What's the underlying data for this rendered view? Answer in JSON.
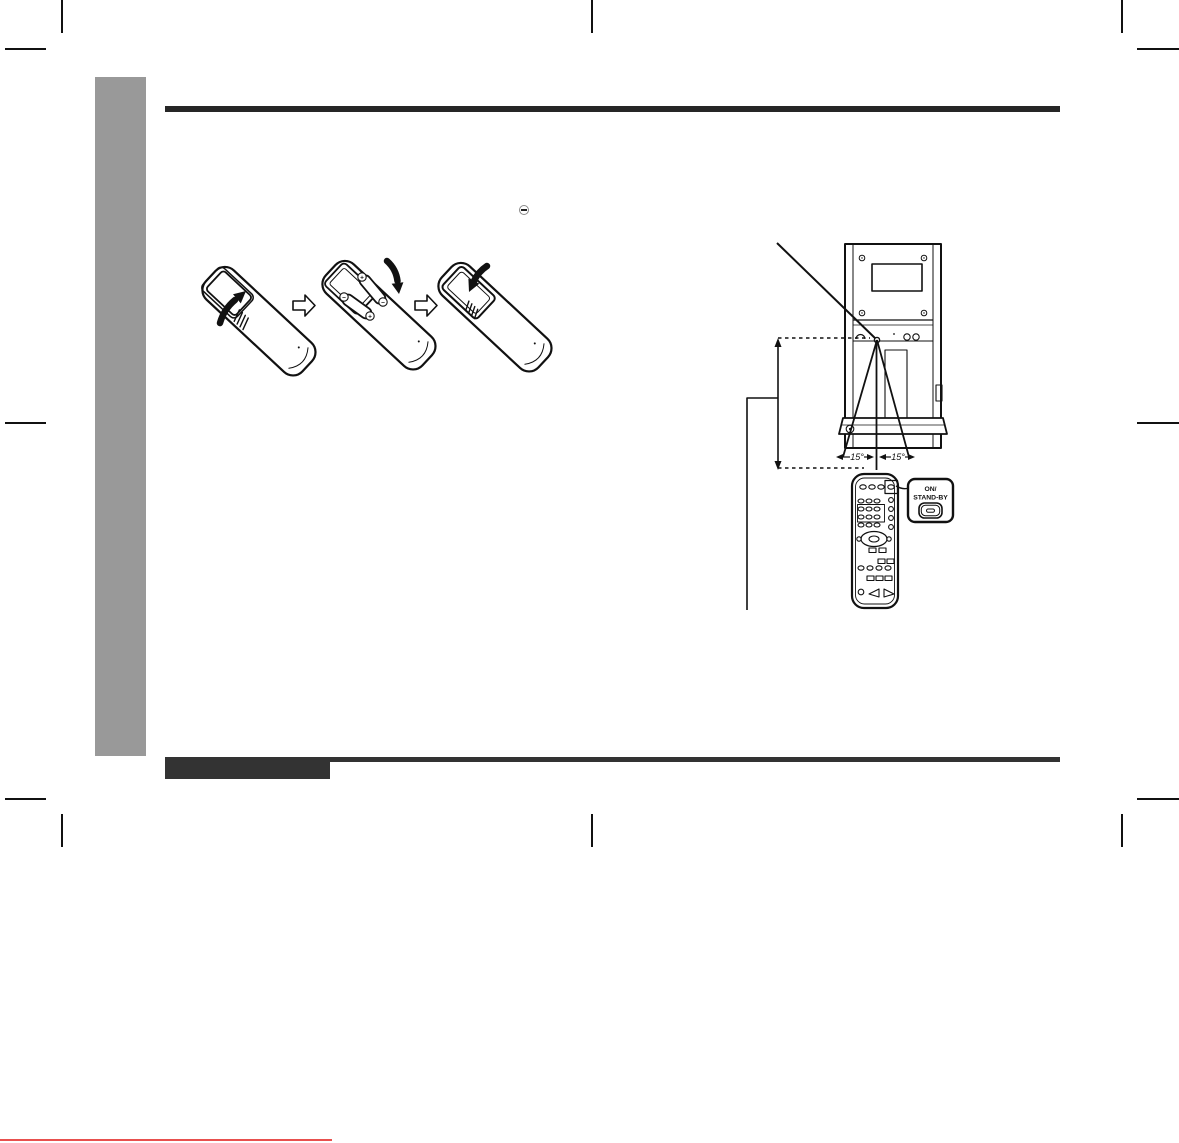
{
  "page": {
    "bg_color": "#ffffff",
    "ink_color": "#111111",
    "sidebar_color": "#999999",
    "header_rule_color": "#262626",
    "footer_bar_color": "#333333",
    "red_line_color": "#e8504e"
  },
  "margin_note": {
    "minus_symbol": "−"
  },
  "battery_diagram": {
    "polarity_plus": "+",
    "polarity_minus": "−"
  },
  "range_diagram": {
    "angle_left_label": "15°",
    "angle_right_label": "15°",
    "callout_title_line1": "ON/",
    "callout_title_line2": "STAND-BY"
  }
}
